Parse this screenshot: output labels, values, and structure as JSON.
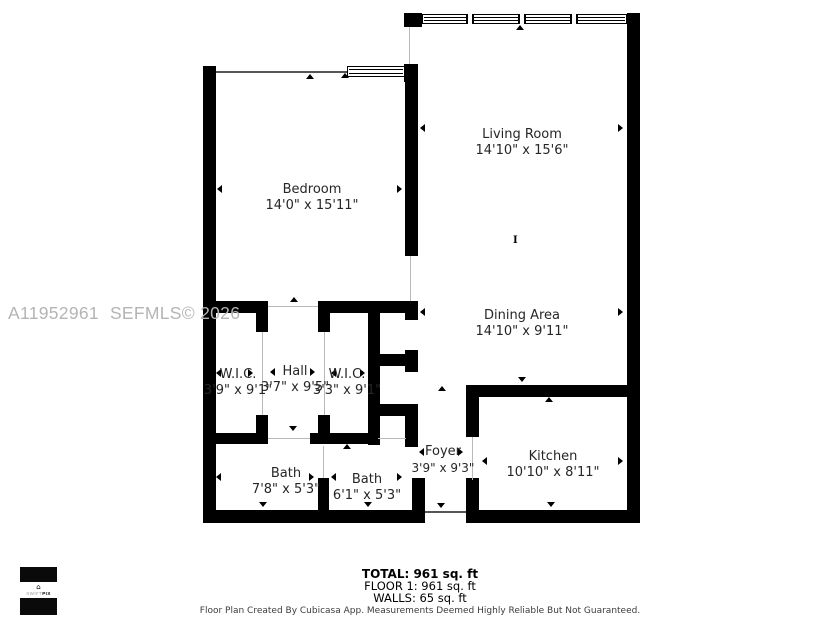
{
  "rooms": [
    {
      "name": "Living Room",
      "dims": "14'10\" x 15'6\""
    },
    {
      "name": "Bedroom",
      "dims": "14'0\" x 15'11\""
    },
    {
      "name": "Dining Area",
      "dims": "14'10\" x 9'11\""
    },
    {
      "name": "W.I.C.",
      "dims": "3'9\" x 9'1\""
    },
    {
      "name": "Hall",
      "dims": "3'7\" x 9'5\""
    },
    {
      "name": "W.I.C.",
      "dims": "3'3\" x 9'1\""
    },
    {
      "name": "Bath",
      "dims": "7'8\" x 5'3\""
    },
    {
      "name": "Bath",
      "dims": "6'1\" x 5'3\""
    },
    {
      "name": "Foyer",
      "dims": "3'9\" x 9'3\""
    },
    {
      "name": "Kitchen",
      "dims": "10'10\" x 8'11\""
    }
  ],
  "summary": {
    "total": "TOTAL: 961 sq. ft",
    "floor1": "FLOOR 1: 961 sq. ft",
    "walls": "WALLS: 65 sq. ft"
  },
  "disclaimer": "Floor Plan Created By Cubicasa App. Measurements Deemed Highly Reliable But Not Guaranteed.",
  "watermark": {
    "mls_id": "A11952961",
    "source": "SEFMLS© 2026"
  },
  "logo": {
    "swift": "SWIFT",
    "pix": "PIX"
  },
  "colors": {
    "wall": "#000000",
    "background": "#ffffff",
    "label": "#262626",
    "watermark": "#b4b4b4"
  }
}
